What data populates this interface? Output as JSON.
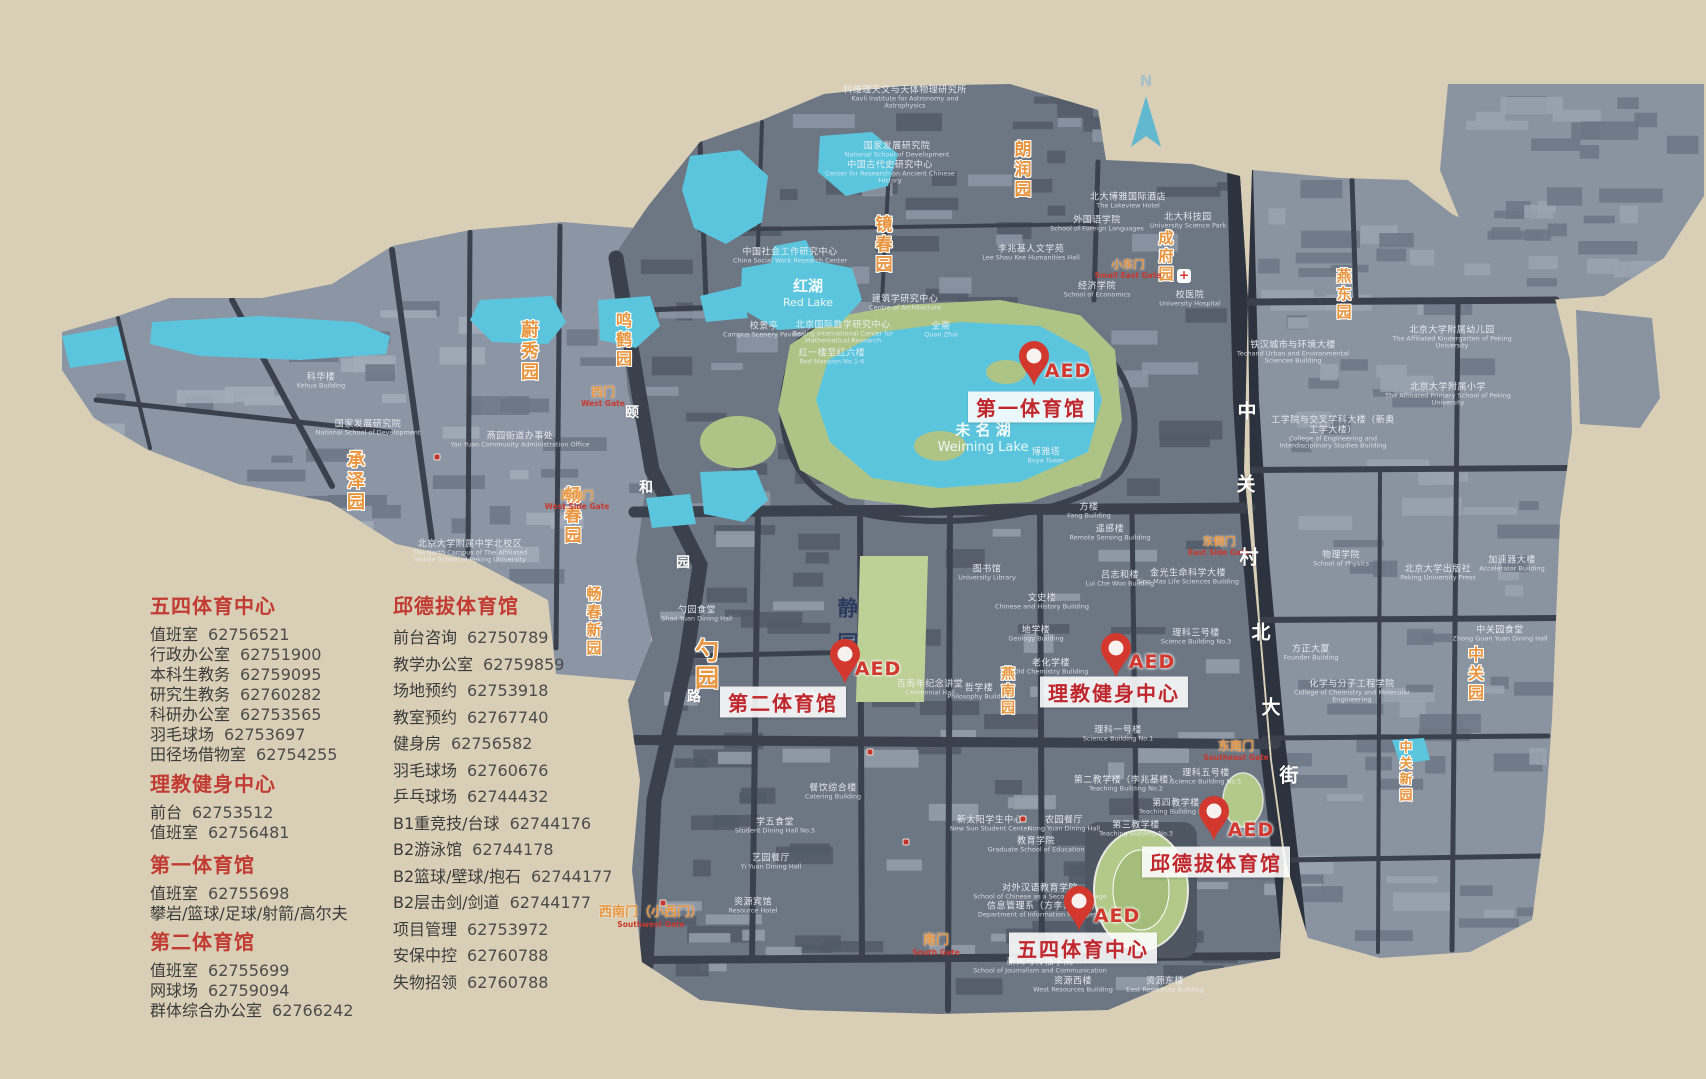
{
  "colors": {
    "background": "#d9cfb6",
    "campus_main": "#6d7683",
    "campus_west": "#8c95a3",
    "campus_east": "#8a93a0",
    "road": "#3a414d",
    "street_dark": "#2d333e",
    "water": "#5cc5de",
    "green": "#aec487",
    "green_field": "#b2c98a",
    "label_red": "#c0272d",
    "aed_red": "#d2382e",
    "garden_orange": "#e8953e",
    "legend_heading": "#c23b33"
  },
  "north": {
    "label": "N"
  },
  "aed_label": "AED",
  "legend": {
    "columns": [
      {
        "x": 150,
        "cls": "col1",
        "sections": [
          {
            "top": 590,
            "title": "五四体育中心",
            "entries": [
              [
                "值班室",
                "62756521"
              ],
              [
                "行政办公室",
                "62751900"
              ],
              [
                "本科生教务",
                "62759095"
              ],
              [
                "研究生教务",
                "62760282"
              ],
              [
                "科研办公室",
                "62753565"
              ],
              [
                "羽毛球场",
                "62753697"
              ],
              [
                "田径场借物室",
                "62754255"
              ]
            ]
          },
          {
            "top": 768,
            "title": "理教健身中心",
            "entries": [
              [
                "前台",
                "62753512"
              ],
              [
                "值班室",
                "62756481"
              ]
            ]
          },
          {
            "top": 849,
            "title": "第一体育馆",
            "entries": [
              [
                "值班室",
                "62755698"
              ],
              [
                "攀岩/篮球/足球/射箭/高尔夫",
                ""
              ]
            ]
          },
          {
            "top": 926,
            "title": "第二体育馆",
            "entries": [
              [
                "值班室",
                "62755699"
              ],
              [
                "网球场",
                "62759094"
              ],
              [
                "群体综合办公室",
                "62766242"
              ]
            ]
          }
        ]
      },
      {
        "x": 393,
        "cls": "col2",
        "sections": [
          {
            "top": 590,
            "title": "邱德拔体育馆",
            "entries": [
              [
                "前台咨询",
                "62750789"
              ],
              [
                "教学办公室",
                "62759859"
              ],
              [
                "场地预约",
                "62753918"
              ],
              [
                "教室预约",
                "62767740"
              ],
              [
                "健身房",
                "62756582"
              ],
              [
                "羽毛球场",
                "62760676"
              ],
              [
                "乒乓球场",
                "62744432"
              ],
              [
                "B1重竞技/台球",
                "62744176"
              ],
              [
                "B2游泳馆",
                "62744178"
              ],
              [
                "B2篮球/壁球/抱石",
                "62744177"
              ],
              [
                "B2层击剑/剑道",
                "62744177"
              ],
              [
                "项目管理",
                "62753972"
              ],
              [
                "安保中控",
                "62760788"
              ],
              [
                "失物招领",
                "62760788"
              ]
            ]
          }
        ]
      }
    ]
  },
  "facilities": [
    {
      "name": "第一体育馆",
      "pin": [
        1034,
        386
      ],
      "aed": [
        1068,
        371
      ],
      "label": [
        1031,
        407
      ]
    },
    {
      "name": "第二体育馆",
      "pin": [
        845,
        684
      ],
      "aed": [
        878,
        669
      ],
      "label": [
        783,
        702
      ]
    },
    {
      "name": "理教健身中心",
      "pin": [
        1116,
        678
      ],
      "aed": [
        1152,
        662
      ],
      "label": [
        1114,
        692
      ]
    },
    {
      "name": "邱德拔体育馆",
      "pin": [
        1214,
        841
      ],
      "aed": [
        1251,
        830
      ],
      "label": [
        1216,
        862
      ]
    },
    {
      "name": "五四体育中心",
      "pin": [
        1079,
        931
      ],
      "aed": [
        1117,
        916
      ],
      "label": [
        1083,
        948
      ]
    }
  ],
  "gardens": [
    [
      "朗润园",
      1021,
      140,
      17
    ],
    [
      "镜春园",
      882,
      215,
      17
    ],
    [
      "鸣鹤园",
      622,
      312,
      16
    ],
    [
      "蔚秀园",
      528,
      320,
      18
    ],
    [
      "承泽园",
      354,
      450,
      18
    ],
    [
      "畅春园",
      571,
      486,
      17
    ],
    [
      "畅春新园",
      594,
      586,
      15
    ],
    [
      "勺园",
      705,
      638,
      24
    ],
    [
      "燕南园",
      1007,
      666,
      14
    ],
    [
      "成府园",
      1166,
      230,
      15
    ],
    [
      "燕东园",
      1344,
      268,
      15
    ],
    [
      "中关园",
      1474,
      646,
      16
    ],
    [
      "中关新园",
      1404,
      740,
      13
    ]
  ],
  "gates": [
    [
      "西门",
      "West Gate",
      603,
      386,
      12
    ],
    [
      "西侧门",
      "West Side Gate",
      577,
      490,
      11
    ],
    [
      "小东门",
      "Small East Gate",
      1128,
      259,
      11
    ],
    [
      "东侧门",
      "East Side Gate",
      1219,
      536,
      11
    ],
    [
      "东南门",
      "Southeast Gate",
      1236,
      740,
      12
    ],
    [
      "南门",
      "South Gate",
      936,
      934,
      13
    ],
    [
      "西南门（小西门）",
      "Southwest Gate",
      651,
      906,
      13
    ]
  ],
  "streets": {
    "zhongguancun": [
      [
        "中",
        1247,
        410
      ],
      [
        "关",
        1246,
        483
      ],
      [
        "村",
        1249,
        556
      ],
      [
        "北",
        1261,
        631
      ],
      [
        "大",
        1271,
        706
      ],
      [
        "街",
        1289,
        774
      ]
    ],
    "yiheyuan": [
      [
        "颐",
        632,
        412
      ],
      [
        "和",
        646,
        487
      ],
      [
        "园",
        683,
        562
      ],
      [
        "路",
        694,
        696
      ]
    ]
  },
  "lakes": [
    {
      "zh": "红湖",
      "en": "Red Lake",
      "x": 808,
      "y": 292,
      "zfs": 15,
      "efs": 11
    },
    {
      "zh": "未  名  湖",
      "en": "Weiming Lake",
      "x": 983,
      "y": 437,
      "zfs": 15,
      "efs": 13
    }
  ],
  "jingyuan": {
    "name": "静园",
    "x": 847,
    "y": 597
  },
  "buildings": [
    [
      "科维理天文与天体物理研究所",
      "Kavli Institute for Astronomy and Astrophysics",
      905,
      98
    ],
    [
      "国家发展研究院",
      "National School of Development",
      897,
      150
    ],
    [
      "中国古代史研究中心",
      "Center for Research on Ancient Chinese History",
      890,
      173
    ],
    [
      "中国社会工作研究中心",
      "China Social Work Research Center",
      790,
      256
    ],
    [
      "建筑学研究中心",
      "Centre of Architecture",
      905,
      303
    ],
    [
      "北京国际数学研究中心",
      "Beijing International Center for Mathematical Research",
      843,
      333
    ],
    [
      "红一楼至红六楼",
      "Red Mansion No.1-6",
      832,
      357
    ],
    [
      "校景亭",
      "Campus Scenery Pavilion",
      764,
      330
    ],
    [
      "全斋",
      "Quan Zhai",
      941,
      330
    ],
    [
      "北大博雅国际酒店",
      "The Lakeview Hotel",
      1128,
      201
    ],
    [
      "外国语学院",
      "School of Foreign Languages",
      1097,
      224
    ],
    [
      "北大科技园",
      "University Science Park",
      1188,
      221
    ],
    [
      "李兆基人文学苑",
      "Lee Shau Kee Humanities Hall",
      1031,
      253
    ],
    [
      "经济学院",
      "School of Economics",
      1097,
      290
    ],
    [
      "校医院",
      "University Hospital",
      1190,
      299
    ],
    [
      "国家发展研究院",
      "National School of Development",
      368,
      428
    ],
    [
      "科华楼",
      "Kehua Building",
      321,
      381
    ],
    [
      "燕园街道办事处",
      "Yan Yuan Community Administration Office",
      520,
      440
    ],
    [
      "北京大学附属中学北校区",
      "The North Campus of The Affiliated Middle School of Peking University",
      470,
      552
    ],
    [
      "铁汉城市与环境大楼",
      "Techand Urban and Environmental Sciences Building",
      1293,
      353
    ],
    [
      "工学院与交叉学科大楼（新奥工学大楼）",
      "College of Engineering and Interdisciplinary Studies Building",
      1333,
      433
    ],
    [
      "物理学院",
      "School of Physics",
      1341,
      559
    ],
    [
      "方正大厦",
      "Founder Building",
      1311,
      653
    ],
    [
      "化学与分子工程学院",
      "College of Chemistry and Molecular Engineering",
      1352,
      692
    ],
    [
      "北京大学出版社",
      "Peking University Press",
      1438,
      573
    ],
    [
      "加速器大楼",
      "Accelerator Building",
      1512,
      564
    ],
    [
      "中关园食堂",
      "Zhong Guan Yuan Dining Hall",
      1500,
      634
    ],
    [
      "北京大学附属幼儿园",
      "The Affiliated Kindergarten of Peking University",
      1452,
      338
    ],
    [
      "北京大学附属小学",
      "The Affiliated Primary School of Peking University",
      1448,
      395
    ],
    [
      "博雅塔",
      "Boya Tower",
      1046,
      456
    ],
    [
      "图书馆",
      "University Library",
      987,
      573
    ],
    [
      "文史楼",
      "Chinese and History Building",
      1042,
      602
    ],
    [
      "地学楼",
      "Geology Building",
      1036,
      634
    ],
    [
      "老化学楼",
      "Old Chemistry Building",
      1051,
      667
    ],
    [
      "哲学楼",
      "Philosophy Building",
      979,
      692
    ],
    [
      "方楼",
      "Fang Building",
      1089,
      511
    ],
    [
      "遥感楼",
      "Remote Sensing Building",
      1110,
      533
    ],
    [
      "吕志和楼",
      "Lui Che Woo Building",
      1120,
      579
    ],
    [
      "金光生命科学大楼",
      "Sino Mas Life Sciences Building",
      1188,
      577
    ],
    [
      "理科一号楼",
      "Science Building No.1",
      1118,
      734
    ],
    [
      "理科三号楼",
      "Science Building No.3",
      1196,
      637
    ],
    [
      "理科五号楼",
      "Science Building No.5",
      1206,
      777
    ],
    [
      "第二教学楼（李兆基楼）",
      "Teaching Building No.2",
      1126,
      784
    ],
    [
      "第四教学楼",
      "Teaching Building No.4",
      1176,
      807
    ],
    [
      "第三教学楼",
      "Teaching Building No.3",
      1136,
      829
    ],
    [
      "农园餐厅",
      "Nong Yuan Dining Hall",
      1064,
      824
    ],
    [
      "教育学院",
      "Graduate School of Education",
      1036,
      845
    ],
    [
      "新太阳学生中心",
      "New Sun Student Center",
      990,
      824
    ],
    [
      "对外汉语教育学院",
      "School of Chinese as a Second Language",
      1040,
      892
    ],
    [
      "信息管理系（方李邦琴楼）",
      "Department of Information Management",
      1044,
      910
    ],
    [
      "新闻与传播学院",
      "School of Journalism and Communication",
      1040,
      966
    ],
    [
      "资源西楼",
      "West Resources Building",
      1073,
      985
    ],
    [
      "资源东楼",
      "East Resources Building",
      1165,
      985
    ],
    [
      "资源宾馆",
      "Resource Hotel",
      753,
      906
    ],
    [
      "百周年纪念讲堂",
      "Centennial Hall",
      930,
      688
    ],
    [
      "餐饮综合楼",
      "Catering Building",
      833,
      792
    ],
    [
      "学五食堂",
      "Student Dining Hall No.5",
      775,
      826
    ],
    [
      "艺园餐厅",
      "Yi Yuan Dining Hall",
      771,
      862
    ],
    [
      "勺园食堂",
      "Shao Yuan Dining Hall",
      697,
      614
    ]
  ],
  "mini_markers": [
    [
      437,
      457
    ],
    [
      870,
      752
    ],
    [
      663,
      903
    ],
    [
      906,
      842
    ],
    [
      1023,
      819
    ]
  ],
  "hospital_cross": {
    "x": 1184,
    "y": 276,
    "glyph": "+"
  }
}
